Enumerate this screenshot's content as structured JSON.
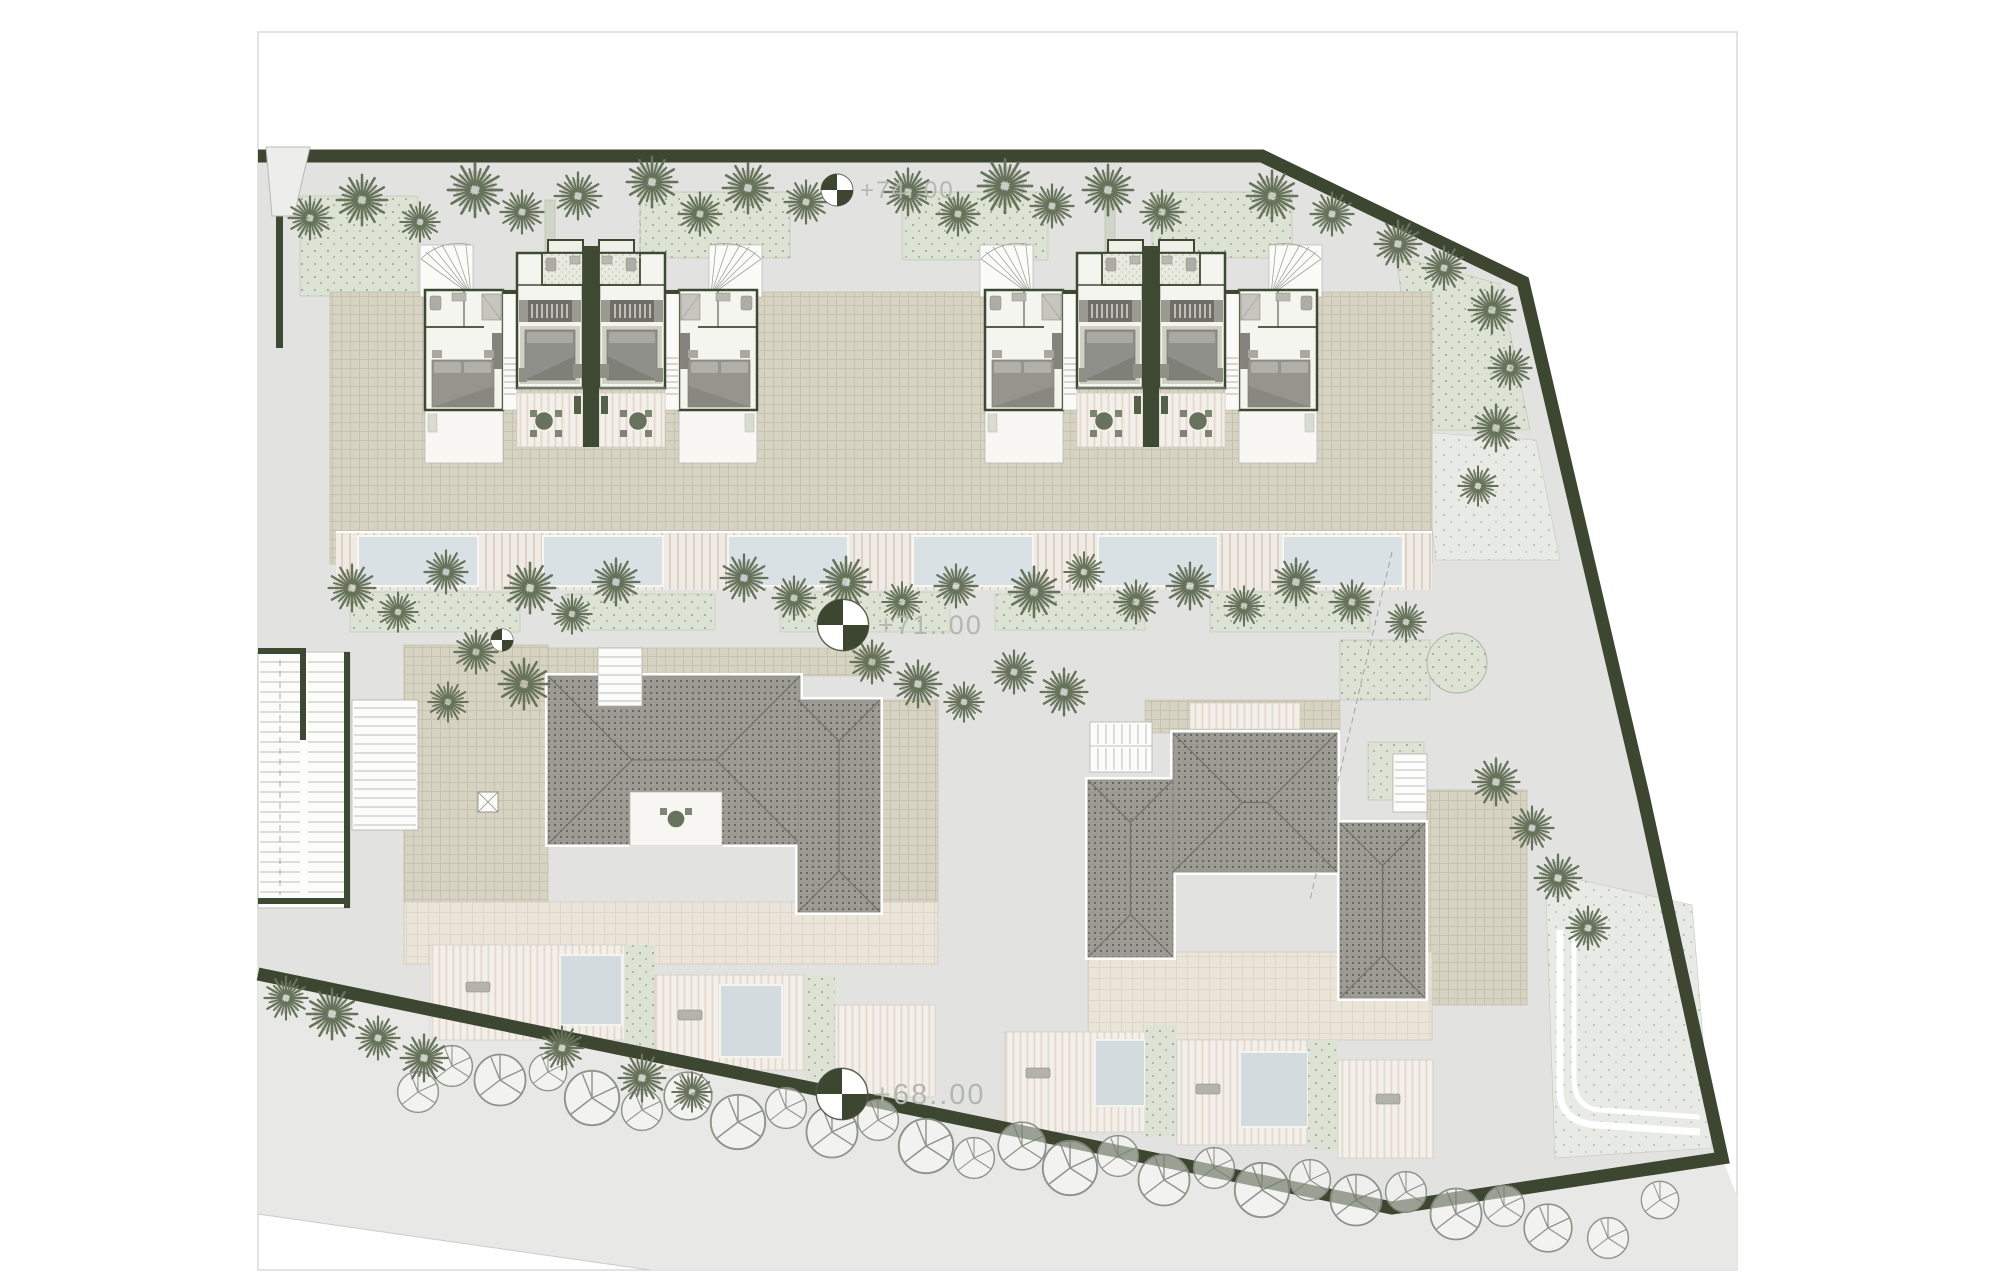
{
  "drawing": {
    "kind": "architectural-site-plan",
    "elevation_markers": {
      "upper": {
        "label": "+74..00"
      },
      "middle": {
        "label": "+71..00"
      },
      "lower": {
        "label": "+68..00"
      }
    },
    "colors": {
      "boundary_green": "#3c4631",
      "wall_green": "#3e4933",
      "terrace_beige": "#d7d3c3",
      "apron_beige": "#eae4d9",
      "roof_gray": "#9e9d95",
      "pool_blue": "#d9e1e4",
      "planting_sage": "#dce2d4",
      "pavement_gray": "#e2e3e0",
      "page_white": "#ffffff"
    }
  }
}
